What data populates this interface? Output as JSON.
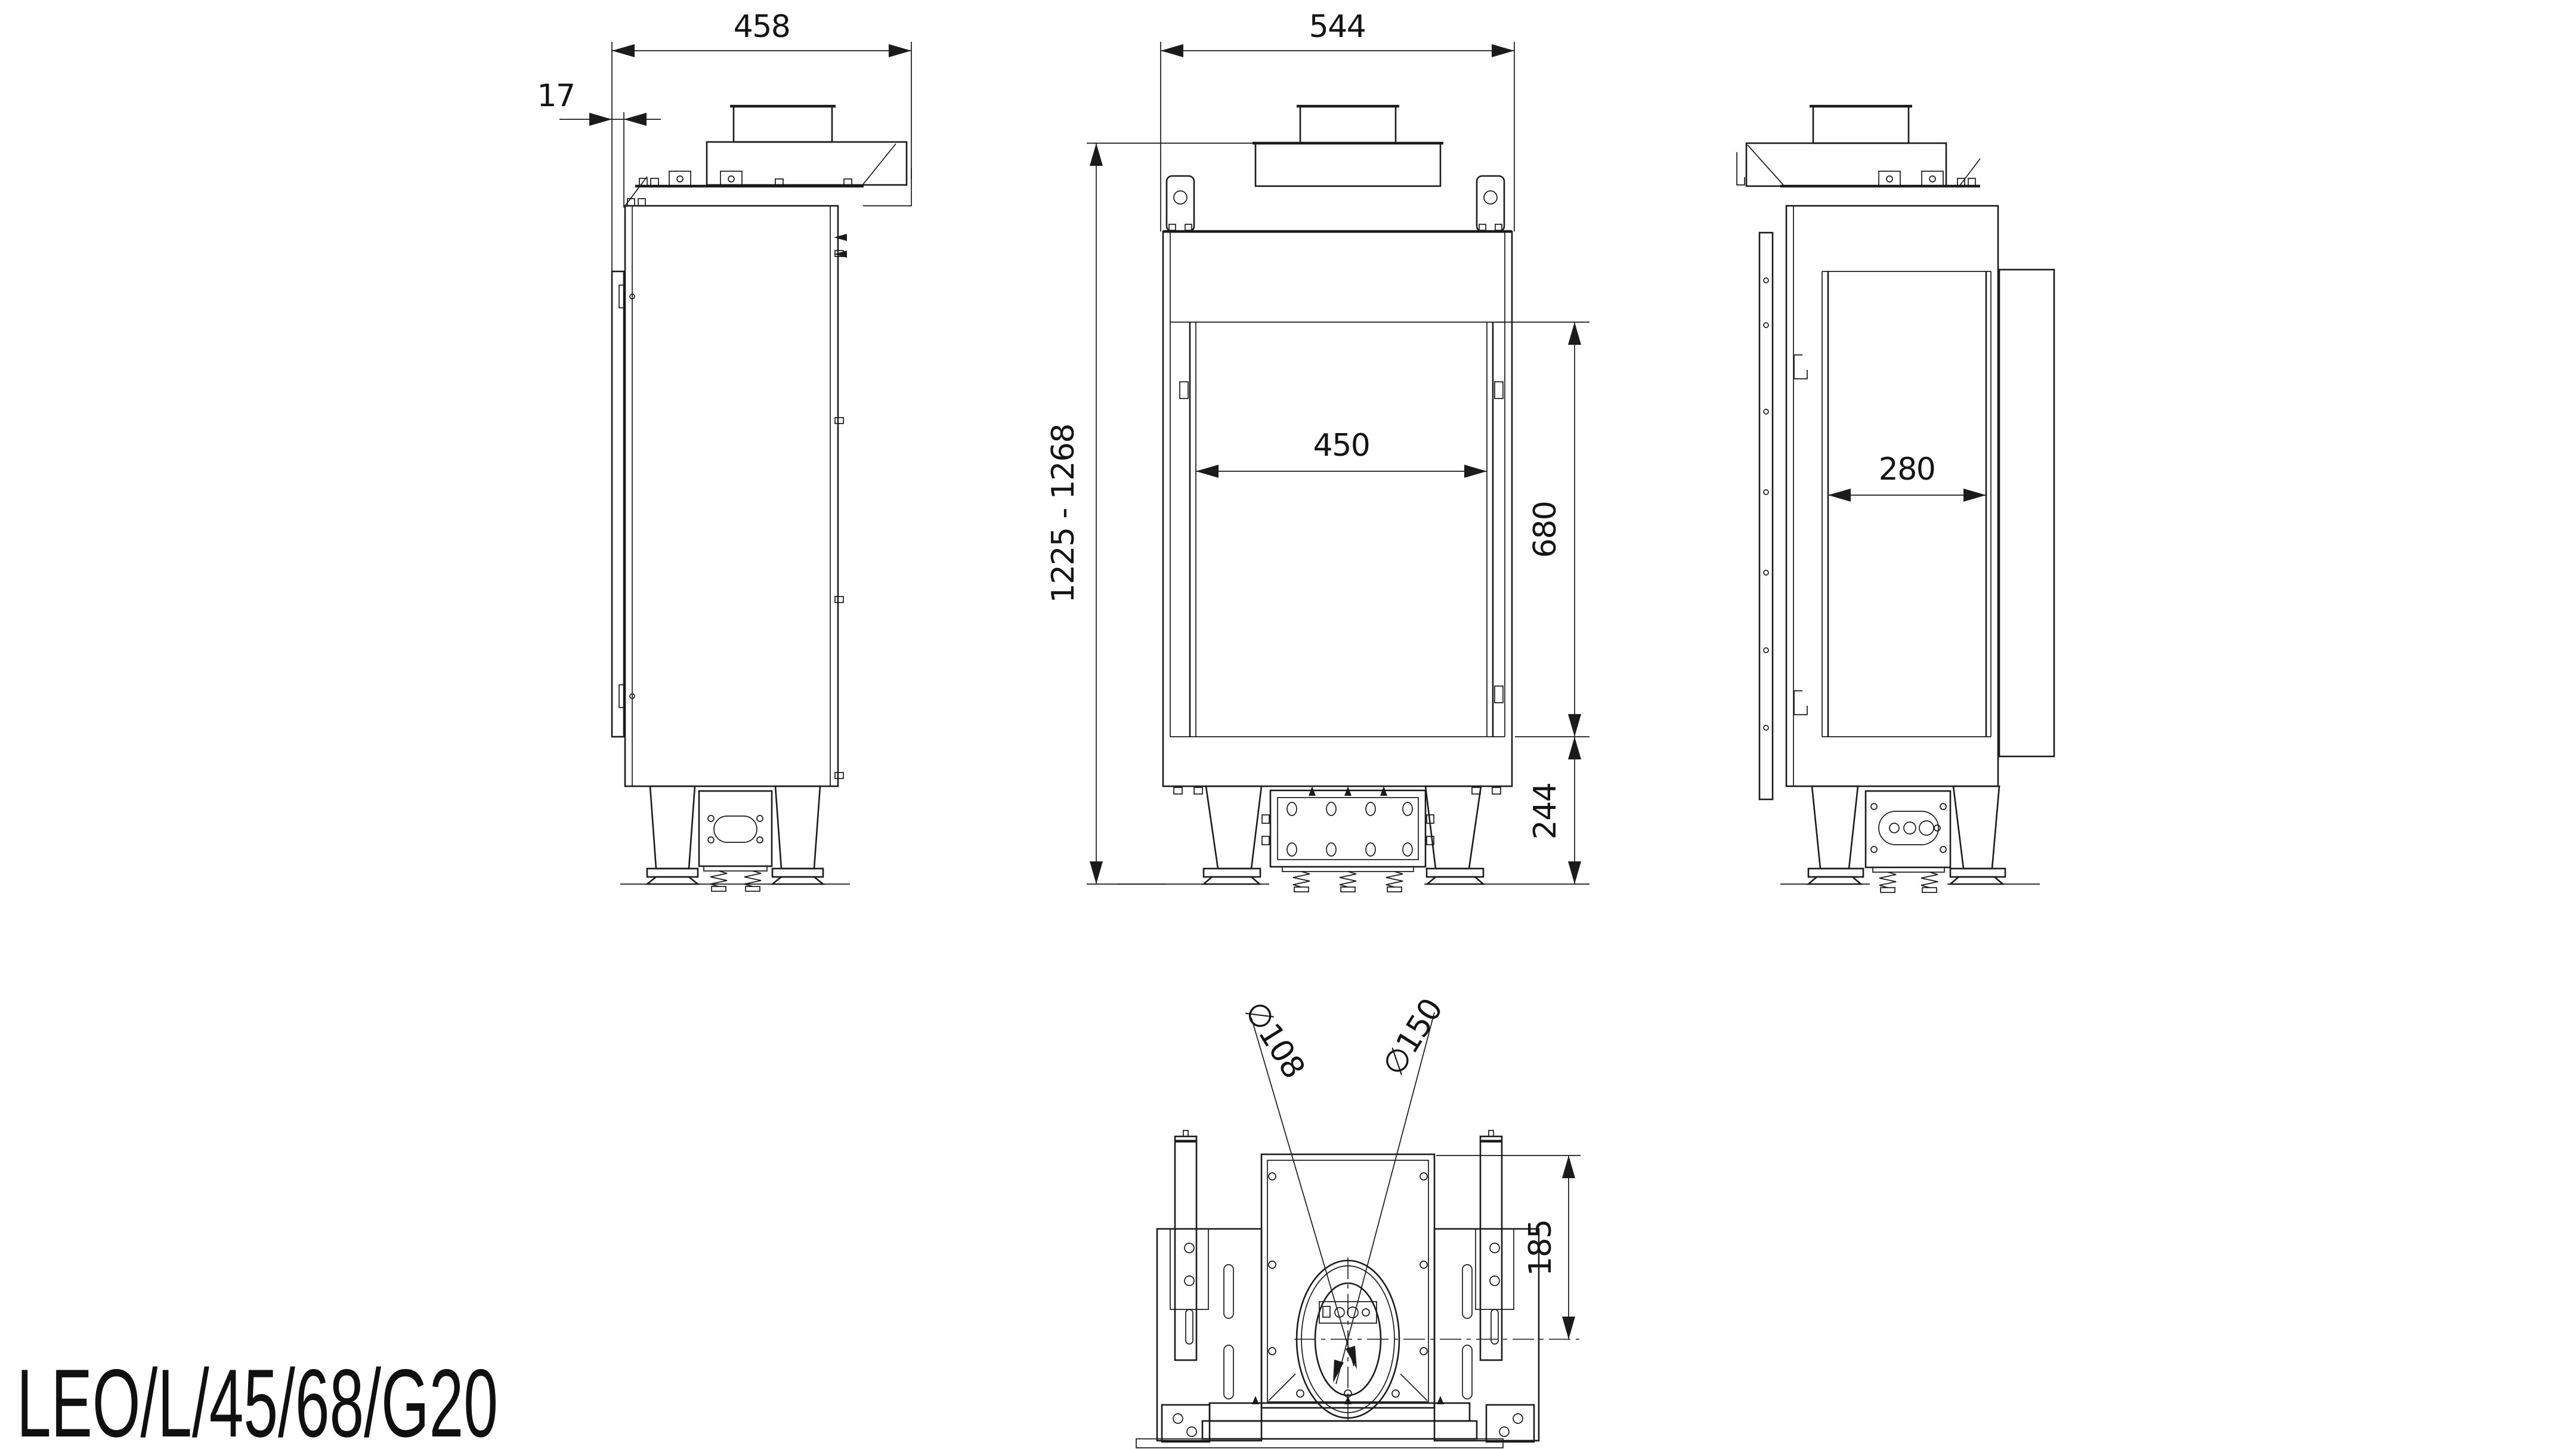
{
  "title": "LEO/L/45/68/G20",
  "colors": {
    "background": "#ffffff",
    "line": "#1b1b1b",
    "text": "#141414"
  },
  "views": {
    "side_left": {
      "label": "left-side-view",
      "dim_depth": "458",
      "dim_glass_offset": "17"
    },
    "front": {
      "label": "front-view",
      "dim_width": "544",
      "dim_glass_width": "450",
      "dim_height_range": "1225 - 1268",
      "dim_glass_height": "680",
      "dim_base_height": "244"
    },
    "side_right": {
      "label": "right-side-view",
      "dim_channel_width": "280"
    },
    "top": {
      "label": "top-view",
      "dim_flue_inner": "∅108",
      "dim_flue_outer": "∅150",
      "dim_flue_center_offset": "185"
    }
  }
}
